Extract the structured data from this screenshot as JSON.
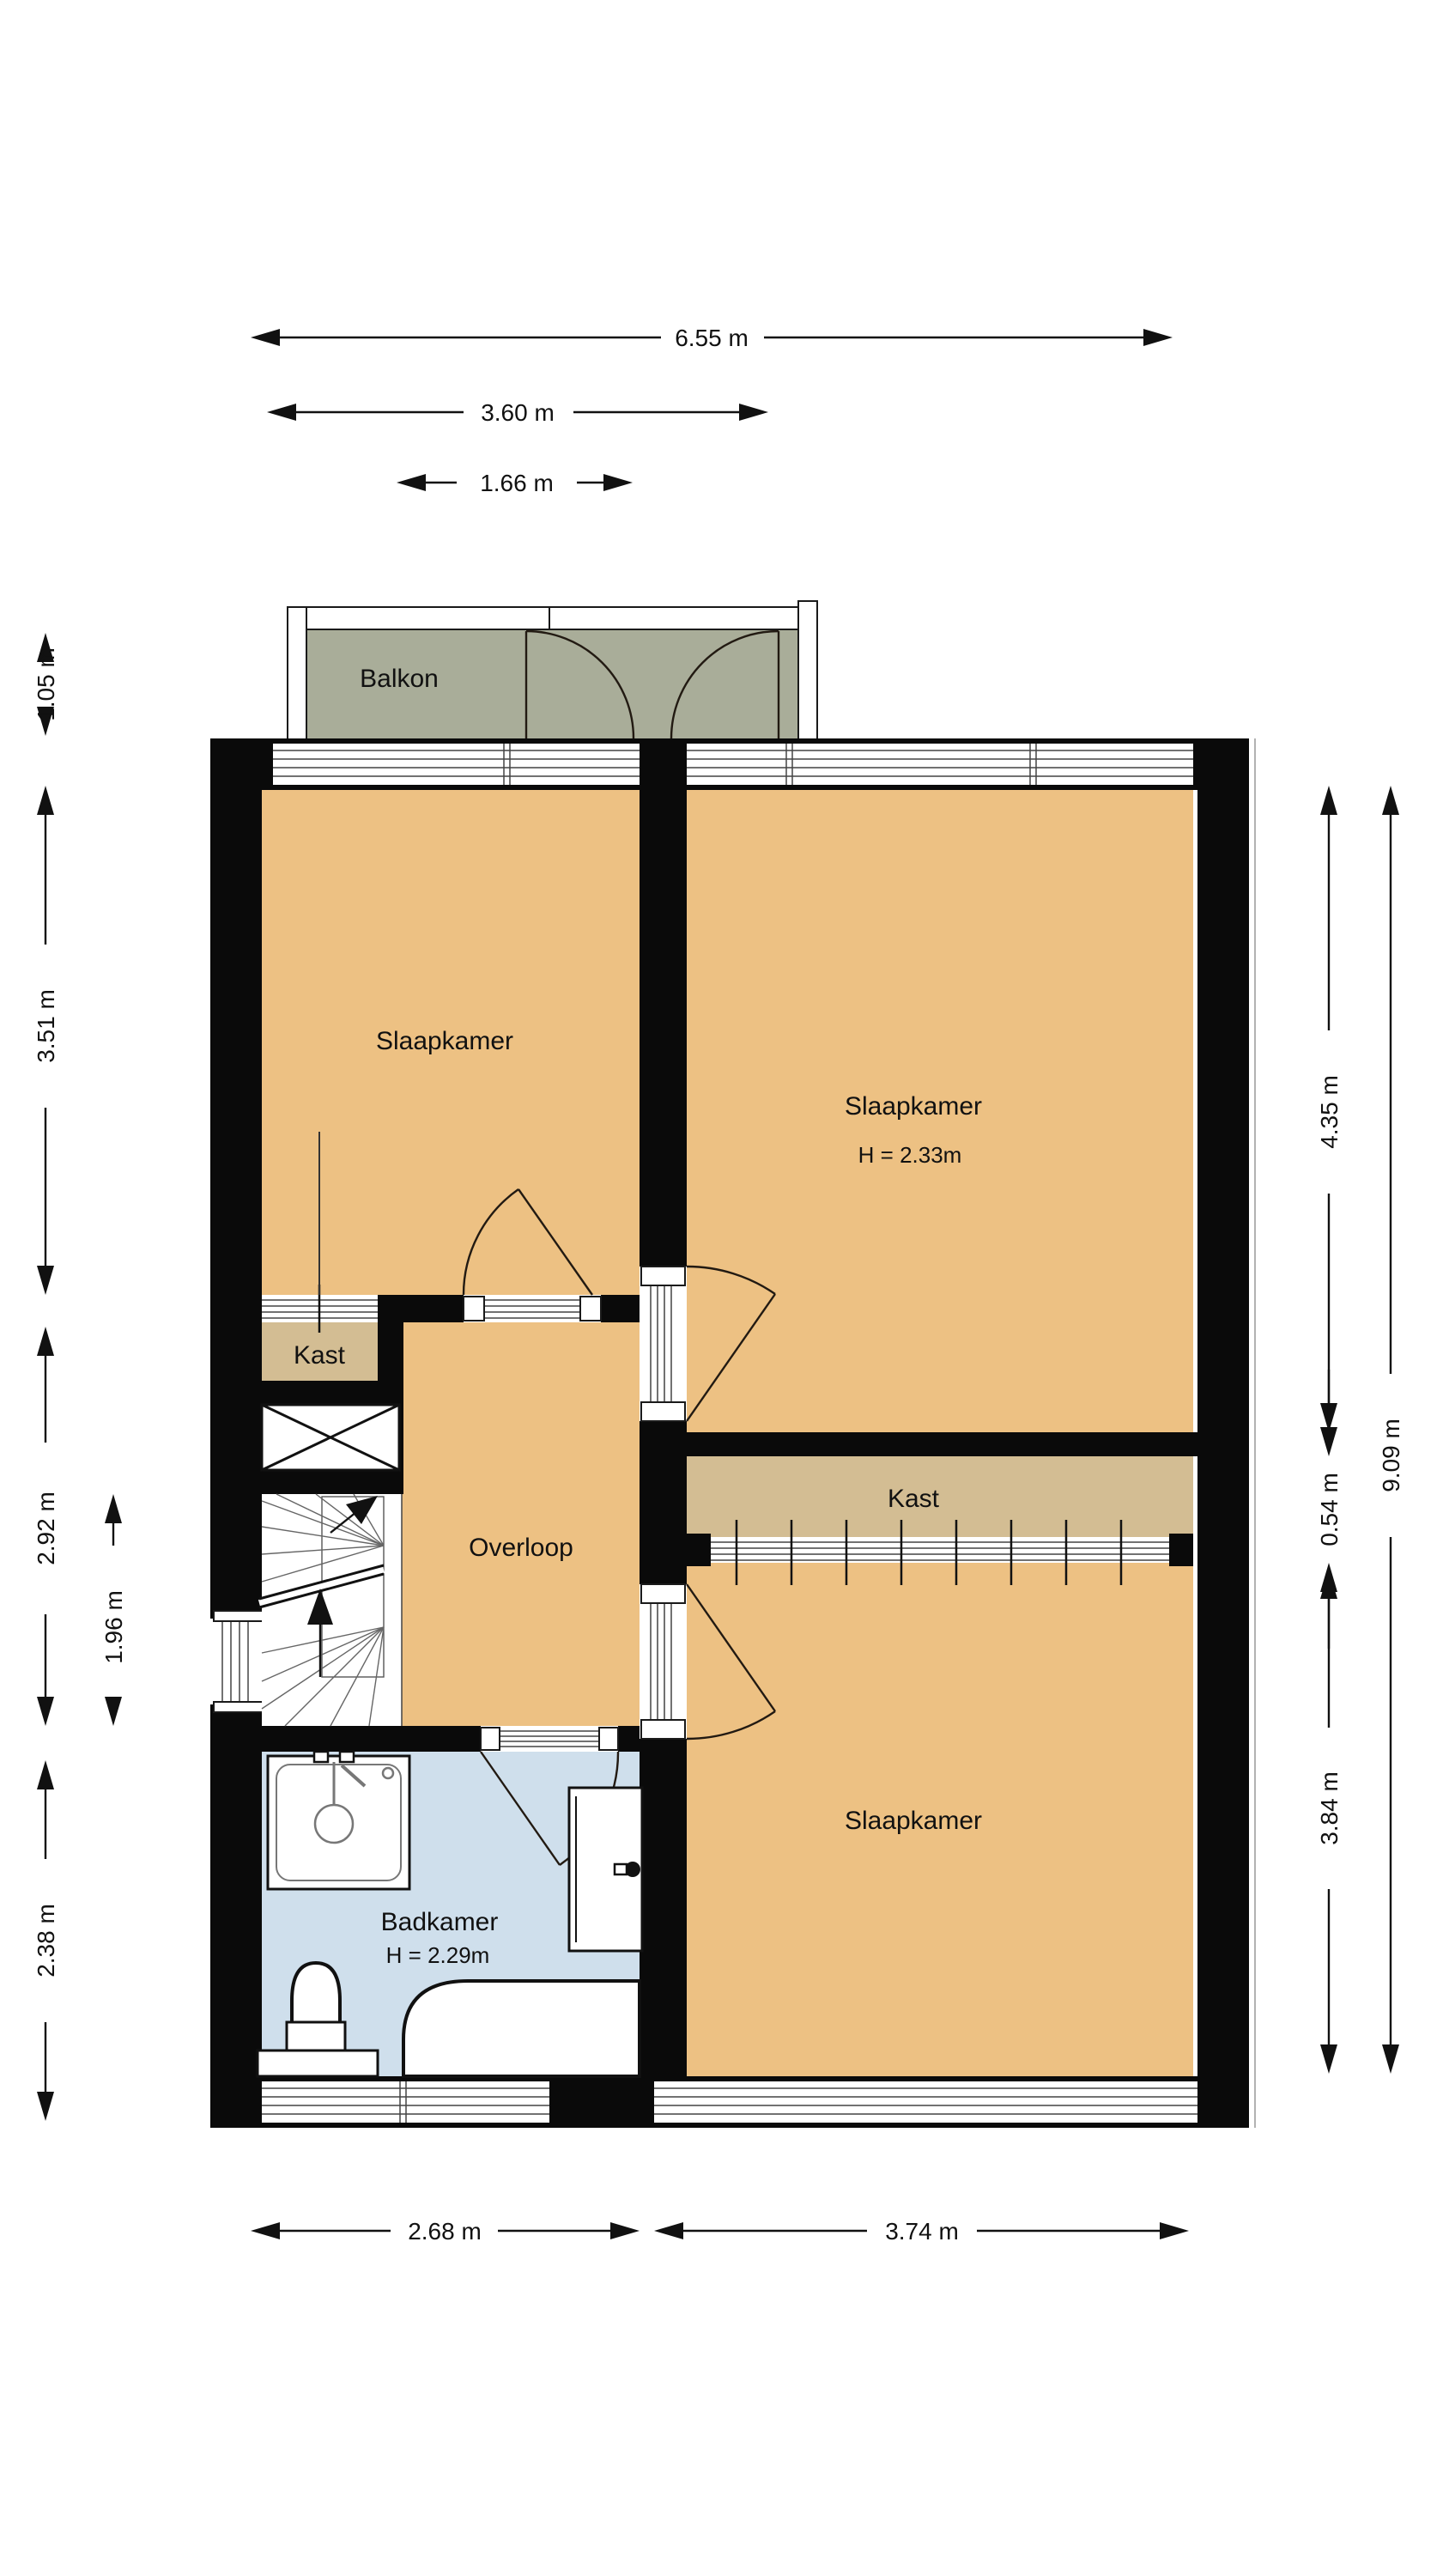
{
  "balcony": {
    "label": "Balkon"
  },
  "rooms": {
    "bedroom_top_left": "Slaapkamer",
    "bedroom_top_right": "Slaapkamer",
    "bedroom_top_right_height": "H = 2.33m",
    "bedroom_bottom": "Slaapkamer",
    "closet_left": "Kast",
    "closet_right": "Kast",
    "landing": "Overloop",
    "bathroom": "Badkamer",
    "bathroom_height": "H = 2.29m"
  },
  "dimensions": {
    "total_width": "6.55 m",
    "balcony_width": "3.60 m",
    "balcony_window": "1.66 m",
    "balcony_depth": "1.05 m",
    "bedroom_left": "3.51 m",
    "landing_left": "2.92 m",
    "stairs": "1.96 m",
    "bathroom_left": "2.38 m",
    "bedroom_right_top": "4.35 m",
    "closet_right": "0.54 m",
    "bedroom_right_bottom": "3.84 m",
    "total_height": "9.09 m",
    "bottom_left": "2.68 m",
    "bottom_right": "3.74 m"
  },
  "colors": {
    "wall_color": "#0a0a0a",
    "room_orange": "#edc183",
    "closet_tan": "#d3bd93",
    "balcony_green": "#a9ad99",
    "bathroom_blue": "#cfdfec"
  }
}
